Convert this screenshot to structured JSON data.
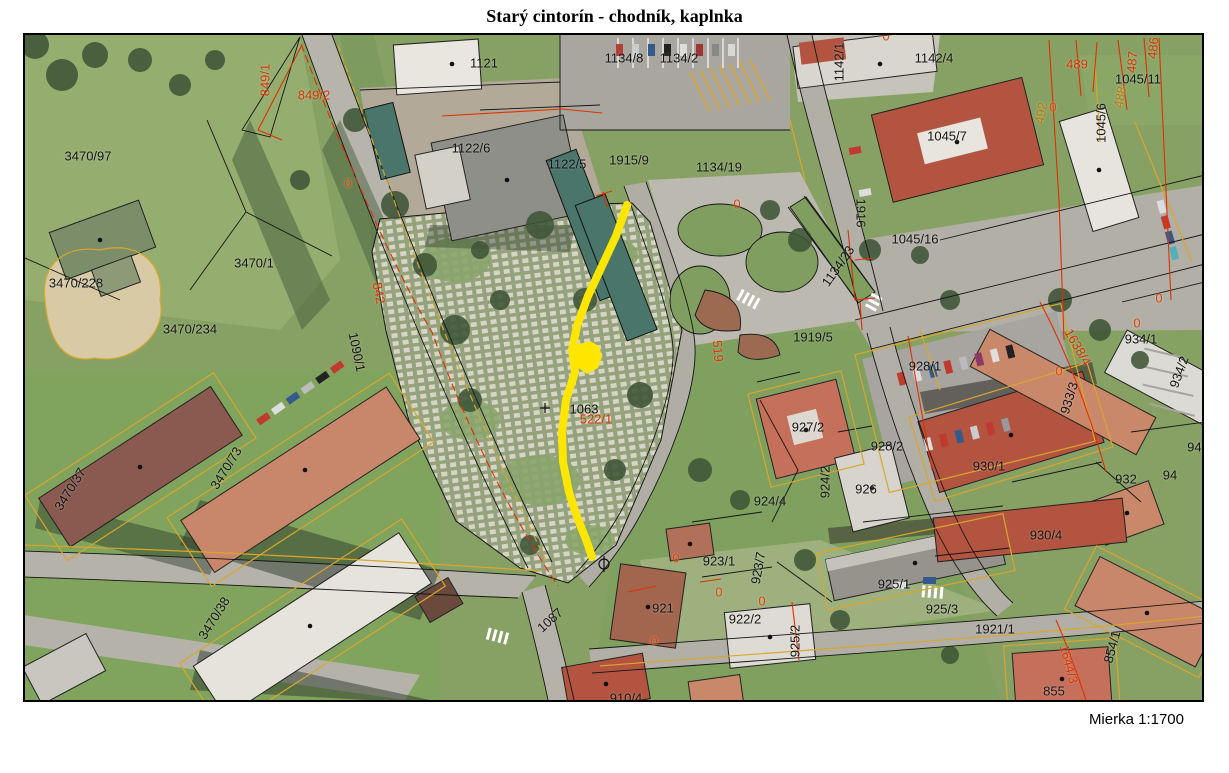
{
  "title": "Starý cintorín - chodník, kaplnka",
  "scale_label": "Mierka 1:1700",
  "map": {
    "highlight_color": "#ffe600",
    "path_points": "627,205 616,236 602,266 588,296 577,326 572,350 575,372 566,400 562,432 563,462 569,492 577,517 587,542 592,557",
    "chapel_points": "576,345 590,341 599,346 602,357 598,368 587,374 577,367 573,355",
    "zero_text": "0",
    "zero_markers": [
      [
        348,
        183
      ],
      [
        737,
        204
      ],
      [
        886,
        36
      ],
      [
        1053,
        107
      ],
      [
        1159,
        298
      ],
      [
        1137,
        323
      ],
      [
        1059,
        371
      ],
      [
        676,
        558
      ],
      [
        719,
        592
      ],
      [
        762,
        601
      ],
      [
        654,
        641
      ]
    ],
    "label_colors": {
      "black": "#141414",
      "red": "#d63500",
      "orange": "#c07800"
    },
    "labels": [
      {
        "t": "3470/97",
        "x": 88,
        "y": 156
      },
      {
        "t": "3470/1",
        "x": 254,
        "y": 263
      },
      {
        "t": "3470/228",
        "x": 76,
        "y": 283
      },
      {
        "t": "3470/234",
        "x": 190,
        "y": 329
      },
      {
        "t": "3470/37",
        "x": 70,
        "y": 489,
        "r": -58
      },
      {
        "t": "3470/73",
        "x": 226,
        "y": 468,
        "r": -58
      },
      {
        "t": "3470/38",
        "x": 214,
        "y": 618,
        "r": -58
      },
      {
        "t": "1121",
        "x": 484,
        "y": 63
      },
      {
        "t": "1122/6",
        "x": 471,
        "y": 148
      },
      {
        "t": "1122/5",
        "x": 567,
        "y": 164
      },
      {
        "t": "1915/9",
        "x": 629,
        "y": 160
      },
      {
        "t": "1134/8",
        "x": 624,
        "y": 58
      },
      {
        "t": "1134/2",
        "x": 679,
        "y": 58
      },
      {
        "t": "1134/19",
        "x": 719,
        "y": 167
      },
      {
        "t": "1134/23",
        "x": 838,
        "y": 266,
        "r": -55
      },
      {
        "t": "1916",
        "x": 861,
        "y": 213,
        "r": 90
      },
      {
        "t": "1142/1",
        "x": 839,
        "y": 62,
        "r": -90
      },
      {
        "t": "1142/4",
        "x": 934,
        "y": 58
      },
      {
        "t": "1045/7",
        "x": 947,
        "y": 136
      },
      {
        "t": "1045/11",
        "x": 1138,
        "y": 79
      },
      {
        "t": "1045/6",
        "x": 1101,
        "y": 123,
        "r": -90
      },
      {
        "t": "1045/16",
        "x": 915,
        "y": 239
      },
      {
        "t": "1919/5",
        "x": 813,
        "y": 337
      },
      {
        "t": "928/1",
        "x": 925,
        "y": 366
      },
      {
        "t": "927/2",
        "x": 808,
        "y": 427
      },
      {
        "t": "928/2",
        "x": 887,
        "y": 446
      },
      {
        "t": "926",
        "x": 866,
        "y": 489
      },
      {
        "t": "924/2",
        "x": 825,
        "y": 482,
        "r": -90
      },
      {
        "t": "924/4",
        "x": 770,
        "y": 501
      },
      {
        "t": "930/1",
        "x": 989,
        "y": 466
      },
      {
        "t": "930/4",
        "x": 1046,
        "y": 535
      },
      {
        "t": "932",
        "x": 1126,
        "y": 479
      },
      {
        "t": "933/3",
        "x": 1069,
        "y": 398,
        "r": -73
      },
      {
        "t": "934/1",
        "x": 1141,
        "y": 339
      },
      {
        "t": "934/2",
        "x": 1179,
        "y": 372,
        "r": -70
      },
      {
        "t": "943",
        "x": 1198,
        "y": 447
      },
      {
        "t": "94",
        "x": 1170,
        "y": 475
      },
      {
        "t": "925/1",
        "x": 894,
        "y": 584
      },
      {
        "t": "925/3",
        "x": 942,
        "y": 609
      },
      {
        "t": "925/2",
        "x": 795,
        "y": 641,
        "r": -90
      },
      {
        "t": "923/1",
        "x": 719,
        "y": 561
      },
      {
        "t": "923/7",
        "x": 758,
        "y": 568,
        "r": -80
      },
      {
        "t": "921",
        "x": 663,
        "y": 608
      },
      {
        "t": "922/2",
        "x": 745,
        "y": 619
      },
      {
        "t": "1921/1",
        "x": 995,
        "y": 629
      },
      {
        "t": "854/1",
        "x": 1112,
        "y": 647,
        "r": -75
      },
      {
        "t": "855",
        "x": 1054,
        "y": 691
      },
      {
        "t": "910/4",
        "x": 626,
        "y": 698
      },
      {
        "t": "1063",
        "x": 584,
        "y": 409
      },
      {
        "t": "1090/1",
        "x": 357,
        "y": 352,
        "r": 78
      },
      {
        "t": "1087",
        "x": 550,
        "y": 620,
        "r": -42
      },
      {
        "t": "522/1",
        "x": 596,
        "y": 419,
        "c": "r"
      },
      {
        "t": "849/1",
        "x": 265,
        "y": 80,
        "c": "r",
        "r": -90
      },
      {
        "t": "849/2",
        "x": 314,
        "y": 95,
        "c": "r"
      },
      {
        "t": "842",
        "x": 379,
        "y": 293,
        "c": "r",
        "r": 80
      },
      {
        "t": "519",
        "x": 718,
        "y": 351,
        "c": "r",
        "r": 85
      },
      {
        "t": "1638/4",
        "x": 1078,
        "y": 347,
        "c": "r",
        "r": 60
      },
      {
        "t": "1644/3",
        "x": 1069,
        "y": 664,
        "c": "r",
        "r": 75
      },
      {
        "t": "489",
        "x": 1077,
        "y": 64,
        "c": "r"
      },
      {
        "t": "492",
        "x": 1041,
        "y": 113,
        "c": "o",
        "r": -80
      },
      {
        "t": "488",
        "x": 1120,
        "y": 97,
        "c": "o",
        "r": -80
      },
      {
        "t": "487",
        "x": 1132,
        "y": 62,
        "c": "r",
        "r": -85
      },
      {
        "t": "486",
        "x": 1153,
        "y": 48,
        "c": "r",
        "r": -85
      }
    ]
  }
}
